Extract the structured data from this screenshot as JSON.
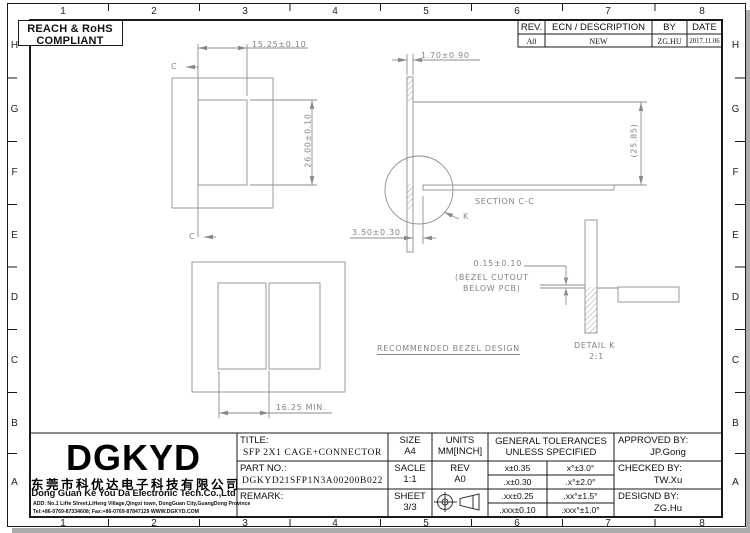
{
  "compliance": {
    "line1": "REACH & RoHS",
    "line2": "COMPLIANT"
  },
  "rev_table": {
    "rev_header": "REV.",
    "ecn_header": "ECN / DESCRIPTION",
    "by_header": "BY",
    "date_header": "DATE",
    "rev": "A0",
    "ecn": "NEW",
    "by": "ZG.HU",
    "date": "2017.11.06"
  },
  "grid": {
    "cols": [
      "1",
      "2",
      "3",
      "4",
      "5",
      "6",
      "7",
      "8"
    ],
    "rows": [
      "H",
      "G",
      "F",
      "E",
      "D",
      "C",
      "B",
      "A"
    ]
  },
  "views": {
    "front": {
      "dim_width": "15.25±0.10",
      "dim_height": "26.00±0.10",
      "section_top": "C",
      "section_bottom": "C"
    },
    "section": {
      "caption": "SECTION C-C",
      "dim_thickness": "1.70±0.90",
      "dim_height": "(25.85)",
      "dim_offset": "3.50±0.30",
      "detail_ref": "K"
    },
    "detail": {
      "caption": "DETAIL K",
      "scale": "2:1",
      "dim_gap": "0.15±0.10",
      "note1": "(BEZEL CUTOUT",
      "note2": "BELOW PCB)"
    },
    "bezel": {
      "caption": "RECOMMENDED BEZEL DESIGN",
      "dim_min": "16.25 MIN."
    }
  },
  "title_block": {
    "logo": "DGKYD",
    "company_cn": "东莞市科优达电子科技有限公司",
    "company_en": "Dong Guan Ke You Da Electronic Tech.Co.,Ltd",
    "address": "ADD: No.1 LiHe Street,LiHeng Village,Qingxi town, DongGuan City,GuangDong Province",
    "contact": "Tel:+86-0769-87334608; Fax:+86-0769-87847129  WWW.DGKYD.COM",
    "title_label": "TITLE:",
    "title_value": "SFP 2X1 CAGE+CONNECTOR",
    "part_label": "PART NO.:",
    "part_value": "DGKYD21SFP1N3A00200B022",
    "remark_label": "REMARK:",
    "size_label": "SIZE",
    "size_value": "A4",
    "scale_label": "SACLE",
    "scale_value": "1:1",
    "sheet_label": "SHEET",
    "sheet_value": "3/3",
    "units_label": "UNITS",
    "units_value": "MM[INCH]",
    "rev_label": "REV",
    "rev_value": "A0",
    "tol_header1": "GENERAL TOLERANCES",
    "tol_header2": "UNLESS SPECIFIED",
    "tolerances": [
      [
        "x±0.35",
        "x°±3.0°"
      ],
      [
        ".x±0.30",
        ".x°±2.0°"
      ],
      [
        ".xx±0.25",
        ".xx°±1.5°"
      ],
      [
        ".xxx±0.10",
        ".xxx°±1.0°"
      ]
    ],
    "approved_label": "APPROVED BY:",
    "approved_value": "JP.Gong",
    "checked_label": "CHECKED BY:",
    "checked_value": "TW.Xu",
    "designed_label": "DESIGND BY:",
    "designed_value": "ZG.Hu"
  },
  "colors": {
    "line_gray": "#8e8e8e",
    "border_black": "#1a1a1a",
    "dim_text": "#838383"
  }
}
